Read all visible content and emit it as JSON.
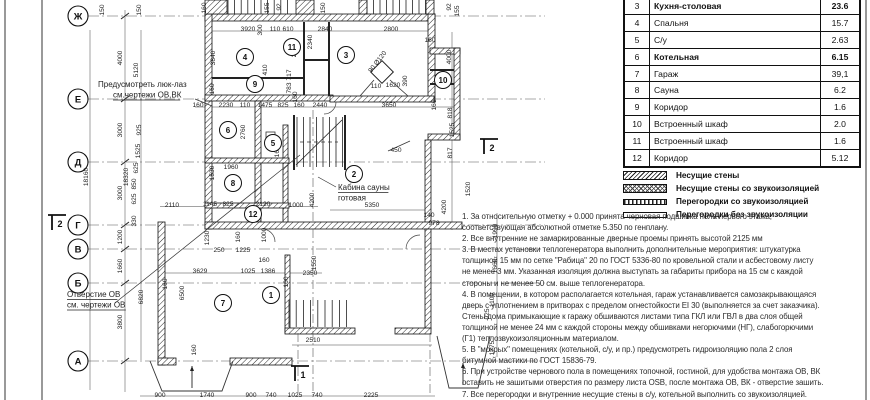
{
  "table": {
    "rows": [
      {
        "num": "3",
        "name": "Кухня-столовая",
        "area": "23.6",
        "bold": true
      },
      {
        "num": "4",
        "name": "Спальня",
        "area": "15.7",
        "bold": false
      },
      {
        "num": "5",
        "name": "С/у",
        "area": "2.63",
        "bold": false
      },
      {
        "num": "6",
        "name": "Котельная",
        "area": "6.15",
        "bold": true
      },
      {
        "num": "7",
        "name": "Гараж",
        "area": "39,1",
        "bold": false
      },
      {
        "num": "8",
        "name": "Сауна",
        "area": "6.2",
        "bold": false
      },
      {
        "num": "9",
        "name": "Коридор",
        "area": "1.6",
        "bold": false
      },
      {
        "num": "10",
        "name": "Встроенный  шкаф",
        "area": "2.0",
        "bold": false
      },
      {
        "num": "11",
        "name": "Встроенный  шкаф",
        "area": "1.6",
        "bold": false
      },
      {
        "num": "12",
        "name": "Коридор",
        "area": "5.12",
        "bold": false
      }
    ]
  },
  "legend": {
    "items": [
      {
        "key": "bearing",
        "label": "Несущие стены"
      },
      {
        "key": "bearing-sound",
        "label": "Несущие стены со звукоизоляцией"
      },
      {
        "key": "partition-sound",
        "label": "Перегородки со звукоизоляцией"
      },
      {
        "key": "partition",
        "label": "Перегородки без звукоизоляции"
      }
    ]
  },
  "notes": {
    "lines": [
      "1. За относительную отметку + 0.000 принята черновая подшивка пола первого этажа,",
      "соответствующая абсолютной отметке 5.350 по генплану.",
      "2. Все внутренние  не замаркированные дверные проемы принять высотой 2125 мм",
      "3. В местах установки теплогенератора выполнить дополнительные мероприятия: штукатурка",
      "толщиной 15 мм по сетке \"Рабица\"   20 по ГОСТ 5336-80 по кровельной стали и асбестовому листу",
      "не менее 3 мм. Указанная изоляция должна выступать за габариты прибора на 15 см с каждой",
      "стороны и не менее 50 см. выше теплогенератора.",
      "4. В помещении, в котором располагается котельная, гараж устанавливается самозакрывающаяся",
      "дверь с уплотнением в притворах с пределом огнестойкости EI 30 (выполняется за счет заказчика).",
      "Стены дома примыкающие к гаражу обшиваются листами типа ГКЛ или ГВЛ в два слоя общей",
      "толщиной не менее 24 мм с каждой стороны между обшивками негорючими (НГ), слабогорючими",
      "(Г1) теплозвукоизоляционным материалом.",
      "5. В \"мокрых\" помещениях (котельной, с/у, и пр.) предусмотреть гидроизоляцию пола 2 слоя",
      "битумной мастики по ГОСТ 15836-79.",
      "6. При устройстве чернового пола в помещениях топочной, гостиной, для удобства монтажа ОВ, ВК",
      "оставить не зашитыми отверстия по размеру листа OSB, после монтажа ОВ, ВК - отверстие зашить.",
      "7. Все перегородки и внутренние несущие стены в с/у, котельной выполнить со звукоизоляцией."
    ]
  },
  "plan": {
    "axes": [
      {
        "label": "Ж",
        "y": 16
      },
      {
        "label": "Е",
        "y": 99
      },
      {
        "label": "Д",
        "y": 162
      },
      {
        "label": "Г",
        "y": 225
      },
      {
        "label": "В",
        "y": 249
      },
      {
        "label": "Б",
        "y": 283
      },
      {
        "label": "А",
        "y": 361
      }
    ],
    "rooms": [
      {
        "n": "1",
        "x": 271,
        "y": 295
      },
      {
        "n": "2",
        "x": 354,
        "y": 174
      },
      {
        "n": "3",
        "x": 346,
        "y": 55
      },
      {
        "n": "4",
        "x": 245,
        "y": 57
      },
      {
        "n": "5",
        "x": 273,
        "y": 143
      },
      {
        "n": "6",
        "x": 228,
        "y": 130
      },
      {
        "n": "7",
        "x": 223,
        "y": 303
      },
      {
        "n": "8",
        "x": 233,
        "y": 183
      },
      {
        "n": "9",
        "x": 255,
        "y": 84
      },
      {
        "n": "10",
        "x": 443,
        "y": 80
      },
      {
        "n": "11",
        "x": 292,
        "y": 47
      },
      {
        "n": "12",
        "x": 253,
        "y": 214
      }
    ],
    "sections": [
      {
        "n": "2",
        "x": 57,
        "y": 224
      },
      {
        "n": "2",
        "x": 489,
        "y": 148
      },
      {
        "n": "1",
        "x": 300,
        "y": 375
      }
    ],
    "annotations": [
      {
        "lines": [
          "Предусмотреть люк-лаз",
          "см.чертежи ОВ,ВК"
        ],
        "xs": [
          98,
          113
        ],
        "y": 87,
        "u": [
          1
        ]
      },
      {
        "lines": [
          "Отверстие ОВ",
          "см. чертежи ОВ"
        ],
        "xs": [
          67,
          67
        ],
        "y": 297,
        "u": [
          0,
          1
        ]
      },
      {
        "lines": [
          "Кабина сауны",
          "готовая"
        ],
        "xs": [
          338,
          338
        ],
        "y": 190,
        "u": [
          0
        ]
      }
    ],
    "dims": [
      {
        "t": "150",
        "x": 104,
        "y": 10,
        "v": 1
      },
      {
        "t": "150",
        "x": 141,
        "y": 10,
        "v": 1
      },
      {
        "t": "160",
        "x": 206,
        "y": 8,
        "v": 1
      },
      {
        "t": "155",
        "x": 269,
        "y": 8,
        "v": 1
      },
      {
        "t": "92",
        "x": 281,
        "y": 7,
        "v": 1
      },
      {
        "t": "150",
        "x": 325,
        "y": 8,
        "v": 1
      },
      {
        "t": "92",
        "x": 451,
        "y": 7,
        "v": 1
      },
      {
        "t": "155",
        "x": 459,
        "y": 11,
        "v": 1
      },
      {
        "t": "3920",
        "x": 248,
        "y": 31
      },
      {
        "t": "300",
        "x": 262,
        "y": 30,
        "v": 1
      },
      {
        "t": "110",
        "x": 275,
        "y": 31
      },
      {
        "t": "610",
        "x": 288,
        "y": 31
      },
      {
        "t": "2840",
        "x": 325,
        "y": 31
      },
      {
        "t": "2800",
        "x": 391,
        "y": 31
      },
      {
        "t": "160",
        "x": 430,
        "y": 42
      },
      {
        "t": "3840",
        "x": 215,
        "y": 58,
        "v": 1
      },
      {
        "t": "2060",
        "x": 296,
        "y": 50,
        "v": 1
      },
      {
        "t": "410",
        "x": 267,
        "y": 70,
        "v": 1
      },
      {
        "t": "2340",
        "x": 312,
        "y": 42,
        "v": 1
      },
      {
        "t": "4000",
        "x": 451,
        "y": 57,
        "v": 1
      },
      {
        "t": "160",
        "x": 214,
        "y": 89,
        "v": 1
      },
      {
        "t": "4000",
        "x": 122,
        "y": 58,
        "v": 1
      },
      {
        "t": "5120",
        "x": 138,
        "y": 70,
        "v": 1
      },
      {
        "t": "717",
        "x": 291,
        "y": 75,
        "v": 1
      },
      {
        "t": "783",
        "x": 291,
        "y": 88,
        "v": 1
      },
      {
        "t": "160",
        "x": 297,
        "y": 97,
        "v": 1
      },
      {
        "t": "110",
        "x": 376,
        "y": 88
      },
      {
        "t": "1620",
        "x": 393,
        "y": 87
      },
      {
        "t": "390",
        "x": 407,
        "y": 81,
        "v": 1
      },
      {
        "t": "90 Ø120",
        "x": 379,
        "y": 63,
        "v": 2
      },
      {
        "t": "160",
        "x": 198,
        "y": 107
      },
      {
        "t": "2230",
        "x": 226,
        "y": 107
      },
      {
        "t": "110",
        "x": 245,
        "y": 107
      },
      {
        "t": "1475",
        "x": 265,
        "y": 107
      },
      {
        "t": "825",
        "x": 283,
        "y": 107
      },
      {
        "t": "160",
        "x": 299,
        "y": 107
      },
      {
        "t": "2440",
        "x": 320,
        "y": 107
      },
      {
        "t": "3650",
        "x": 389,
        "y": 107
      },
      {
        "t": "160",
        "x": 436,
        "y": 105,
        "v": 1
      },
      {
        "t": "818",
        "x": 452,
        "y": 113,
        "v": 1
      },
      {
        "t": "1525",
        "x": 454,
        "y": 130,
        "v": 1
      },
      {
        "t": "817",
        "x": 452,
        "y": 153,
        "v": 1
      },
      {
        "t": "1520",
        "x": 470,
        "y": 189,
        "v": 1
      },
      {
        "t": "3000",
        "x": 122,
        "y": 130,
        "v": 1
      },
      {
        "t": "925",
        "x": 141,
        "y": 130,
        "v": 1
      },
      {
        "t": "1525",
        "x": 140,
        "y": 151,
        "v": 1
      },
      {
        "t": "625",
        "x": 138,
        "y": 168,
        "v": 1
      },
      {
        "t": "850",
        "x": 136,
        "y": 184,
        "v": 1
      },
      {
        "t": "625",
        "x": 136,
        "y": 199,
        "v": 1
      },
      {
        "t": "330",
        "x": 136,
        "y": 221,
        "v": 1
      },
      {
        "t": "18320",
        "x": 128,
        "y": 177,
        "v": 1
      },
      {
        "t": "18160",
        "x": 88,
        "y": 177,
        "v": 1
      },
      {
        "t": "3000",
        "x": 122,
        "y": 193,
        "v": 1
      },
      {
        "t": "1200",
        "x": 122,
        "y": 237,
        "v": 1
      },
      {
        "t": "1660",
        "x": 122,
        "y": 266,
        "v": 1
      },
      {
        "t": "3800",
        "x": 122,
        "y": 322,
        "v": 1
      },
      {
        "t": "6820",
        "x": 143,
        "y": 297,
        "v": 1
      },
      {
        "t": "2760",
        "x": 245,
        "y": 132,
        "v": 1
      },
      {
        "t": "1653",
        "x": 279,
        "y": 150,
        "v": 1
      },
      {
        "t": "1960",
        "x": 231,
        "y": 169
      },
      {
        "t": "1530",
        "x": 214,
        "y": 173,
        "v": 1
      },
      {
        "t": "2110",
        "x": 172,
        "y": 207
      },
      {
        "t": "1145",
        "x": 210,
        "y": 206
      },
      {
        "t": "825",
        "x": 228,
        "y": 206
      },
      {
        "t": "2120",
        "x": 263,
        "y": 206
      },
      {
        "t": "1000",
        "x": 296,
        "y": 207
      },
      {
        "t": "4200",
        "x": 314,
        "y": 200,
        "v": 1
      },
      {
        "t": "5350",
        "x": 372,
        "y": 207
      },
      {
        "t": "1230",
        "x": 209,
        "y": 238,
        "v": 1
      },
      {
        "t": "160",
        "x": 240,
        "y": 237,
        "v": 1
      },
      {
        "t": "1000",
        "x": 266,
        "y": 235,
        "v": 1
      },
      {
        "t": "250",
        "x": 219,
        "y": 252
      },
      {
        "t": "1225",
        "x": 243,
        "y": 252
      },
      {
        "t": "160",
        "x": 264,
        "y": 262
      },
      {
        "t": "450",
        "x": 396,
        "y": 152
      },
      {
        "t": "4200",
        "x": 446,
        "y": 207,
        "v": 1
      },
      {
        "t": "140",
        "x": 429,
        "y": 217
      },
      {
        "t": "978",
        "x": 434,
        "y": 225
      },
      {
        "t": "3629",
        "x": 200,
        "y": 273
      },
      {
        "t": "1025",
        "x": 248,
        "y": 273
      },
      {
        "t": "1386",
        "x": 268,
        "y": 273
      },
      {
        "t": "160",
        "x": 288,
        "y": 282,
        "v": 1
      },
      {
        "t": "2350",
        "x": 310,
        "y": 275
      },
      {
        "t": "1550",
        "x": 316,
        "y": 263,
        "v": 1
      },
      {
        "t": "6500",
        "x": 184,
        "y": 293,
        "v": 1
      },
      {
        "t": "160",
        "x": 167,
        "y": 284,
        "v": 1
      },
      {
        "t": "160",
        "x": 196,
        "y": 350,
        "v": 1
      },
      {
        "t": "2510",
        "x": 313,
        "y": 342
      },
      {
        "t": "1990",
        "x": 497,
        "y": 231,
        "v": 1
      },
      {
        "t": "1660",
        "x": 497,
        "y": 266,
        "v": 1
      },
      {
        "t": "1100",
        "x": 494,
        "y": 300,
        "v": 1
      },
      {
        "t": "925",
        "x": 489,
        "y": 314,
        "v": 1
      },
      {
        "t": "1775",
        "x": 494,
        "y": 348,
        "v": 1
      },
      {
        "t": "900",
        "x": 160,
        "y": 397
      },
      {
        "t": "1740",
        "x": 207,
        "y": 397
      },
      {
        "t": "900",
        "x": 251,
        "y": 397
      },
      {
        "t": "740",
        "x": 271,
        "y": 397
      },
      {
        "t": "1025",
        "x": 295,
        "y": 397
      },
      {
        "t": "740",
        "x": 317,
        "y": 397
      },
      {
        "t": "2225",
        "x": 371,
        "y": 397
      }
    ]
  }
}
